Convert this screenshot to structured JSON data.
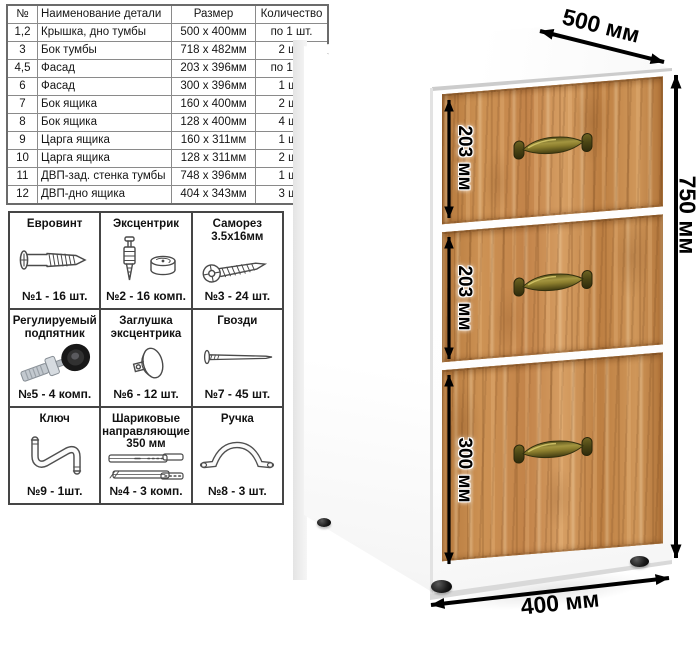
{
  "parts_table": {
    "headers": [
      "№",
      "Наименование детали",
      "Размер",
      "Количество"
    ],
    "rows": [
      {
        "num": "1,2",
        "name": "Крышка, дно тумбы",
        "size": "500 х 400мм",
        "qty": "по 1 шт."
      },
      {
        "num": "3",
        "name": "Бок тумбы",
        "size": "718 х 482мм",
        "qty": "2 шт."
      },
      {
        "num": "4,5",
        "name": "Фасад",
        "size": "203 х 396мм",
        "qty": "по 1 шт."
      },
      {
        "num": "6",
        "name": "Фасад",
        "size": "300 х 396мм",
        "qty": "1 шт."
      },
      {
        "num": "7",
        "name": "Бок ящика",
        "size": "160 х 400мм",
        "qty": "2 шт."
      },
      {
        "num": "8",
        "name": "Бок ящика",
        "size": "128 х 400мм",
        "qty": "4 шт."
      },
      {
        "num": "9",
        "name": "Царга ящика",
        "size": "160 х 311мм",
        "qty": "1 шт."
      },
      {
        "num": "10",
        "name": "Царга ящика",
        "size": "128 х 311мм",
        "qty": "2 шт."
      },
      {
        "num": "11",
        "name": "ДВП-зад. стенка тумбы",
        "size": "748 х 396мм",
        "qty": "1 шт."
      },
      {
        "num": "12",
        "name": "ДВП-дно ящика",
        "size": "404 х 343мм",
        "qty": "3 шт."
      }
    ]
  },
  "hardware": {
    "cells": [
      {
        "title": "Евровинт",
        "count": "№1 - 16 шт.",
        "icon": "euro-screw-icon"
      },
      {
        "title": "Эксцентрик",
        "count": "№2 - 16 комп.",
        "icon": "cam-lock-icon"
      },
      {
        "title": "Саморез\n3.5х16мм",
        "count": "№3 - 24 шт.",
        "icon": "self-tapping-screw-icon"
      },
      {
        "title": "Регулируемый\nподпятник",
        "count": "№5 - 4 комп.",
        "icon": "adjustable-foot-icon"
      },
      {
        "title": "Заглушка\nэксцентрика",
        "count": "№6 - 12 шт.",
        "icon": "cam-cover-icon"
      },
      {
        "title": "Гвозди",
        "count": "№7 - 45 шт.",
        "icon": "nail-icon"
      },
      {
        "title": "Ключ",
        "count": "№9 - 1шт.",
        "icon": "hex-key-icon"
      },
      {
        "title": "Шариковые\nнаправляющие\n350 мм",
        "count": "№4 - 3 комп.",
        "icon": "ball-slides-icon"
      },
      {
        "title": "Ручка",
        "count": "№8 - 3 шт.",
        "icon": "handle-icon"
      }
    ]
  },
  "dimensions": {
    "depth": "500 мм",
    "height": "750 мм",
    "width": "400 мм",
    "drawer1": "203 мм",
    "drawer2": "203 мм",
    "drawer3": "300 мм"
  },
  "colors": {
    "wood": "#c18449",
    "handle_brass": "#8d7f2e",
    "arrow": "#000000",
    "grid_border": "#454545"
  }
}
